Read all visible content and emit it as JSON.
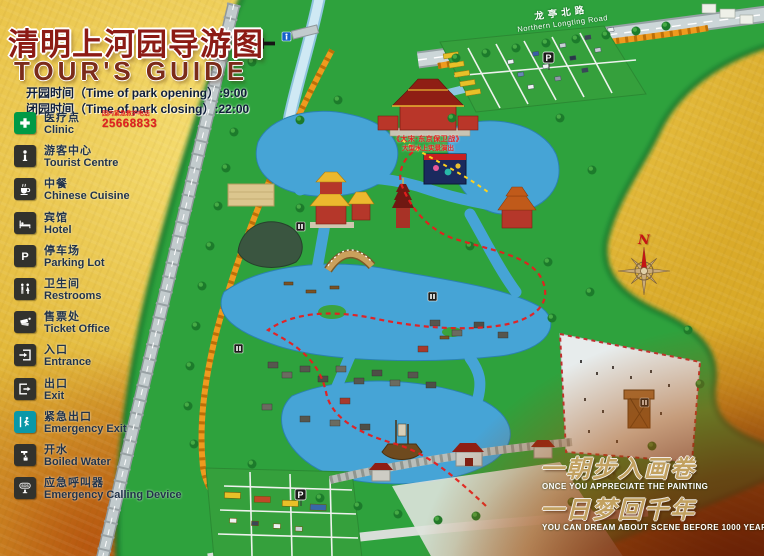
{
  "header": {
    "title_zh": "清明上河园导游图",
    "title_en": "TOUR'S  GUIDE",
    "opening_line": "开园时间（Time of park opening）:9:00",
    "closing_line": "闭园时间（Time of park closing）:22:00"
  },
  "legend": {
    "items": [
      {
        "zh": "医疗点",
        "en": "Clinic"
      },
      {
        "zh": "游客中心",
        "en": "Tourist Centre"
      },
      {
        "zh": "中餐",
        "en": "Chinese Cuisine"
      },
      {
        "zh": "宾馆",
        "en": "Hotel"
      },
      {
        "zh": "停车场",
        "en": "Parking Lot"
      },
      {
        "zh": "卫生间",
        "en": "Restrooms"
      },
      {
        "zh": "售票处",
        "en": "Ticket Office"
      },
      {
        "zh": "入口",
        "en": "Entrance"
      },
      {
        "zh": "出口",
        "en": "Exit"
      },
      {
        "zh": "紧急出口",
        "en": "Emergency Exit"
      },
      {
        "zh": "开水",
        "en": "Boiled Water"
      },
      {
        "zh": "应急呼叫器",
        "en": "Emergency Calling Device"
      }
    ],
    "clinic_phone_note": "园内紧急救护电话",
    "clinic_phone_number": "25668833"
  },
  "icons": {
    "parking_letter": "P",
    "sos_label": "SOS"
  },
  "map": {
    "road_name_zh": "龙亭北路",
    "road_name_en": "Northern Longting Road",
    "show_label_line1": "《大宋·东京保卫战》",
    "show_label_line2": "大型水上实景演出",
    "compass_n": "N",
    "parking_sign": "P"
  },
  "slogan": {
    "line1_zh": "一朝步入画卷",
    "line1_en": "ONCE YOU APPRECIATE THE PAINTING",
    "line2_zh": "一日梦回千年",
    "line2_en": "YOU CAN DREAM ABOUT SCENE BEFORE 1000 YEARS"
  },
  "colors": {
    "background_gold": "#e3b93a",
    "park_green": "#2fa23c",
    "water_blue": "#46a4d6",
    "title_red": "#8c1b15",
    "wall_orange": "#ef9a1e",
    "route_red": "#e81e1e"
  }
}
